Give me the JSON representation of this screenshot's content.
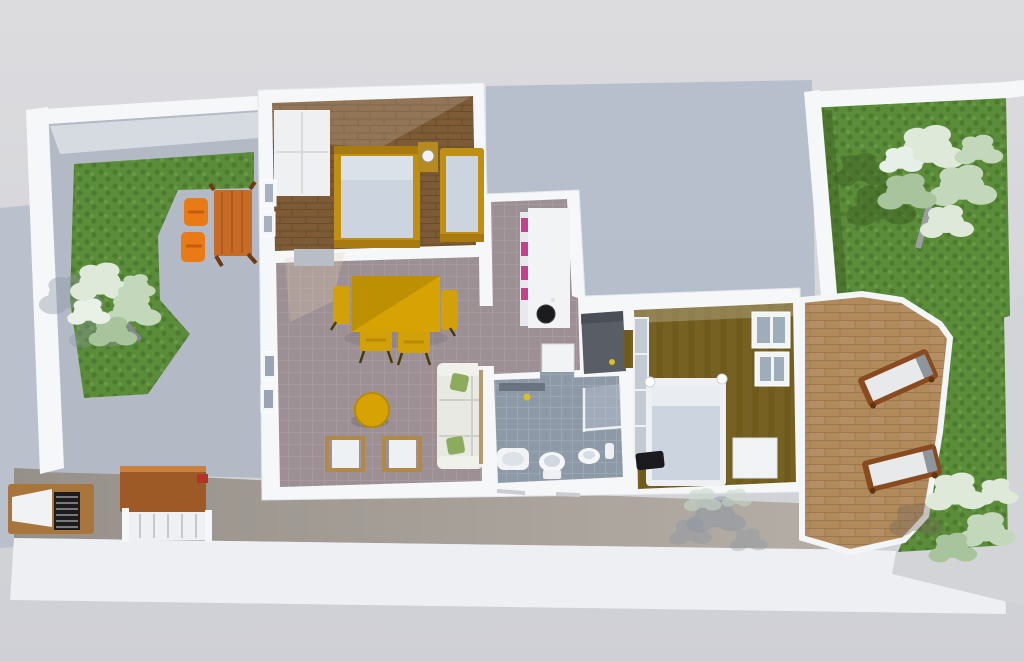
{
  "scene": {
    "type": "3d-floorplan-render",
    "view": "top-down aerial",
    "subject": "two-bedroom apartment with side gardens, patio and terrace"
  },
  "palette": {
    "bg_top": "#dcdcdf",
    "bg_bottom": "#cfd0d5",
    "shadow": "#b5bdca",
    "wall": "#f5f7f9",
    "outer_face": "#edeff2",
    "se_wall": "#d3d4d8",
    "front_wall_dark": "#96908a",
    "front_wall_light": "#b5afa7",
    "concrete": "#b3bac6",
    "concrete_lit": "#dfe3e8",
    "grass": "#5b8c3a",
    "grass_dark": "#4c7a2e",
    "grass_light": "#6a9c46",
    "tile_living": "#9c9095",
    "tile_living_line": "#aca0a5",
    "tile_bath": "#8e99a8",
    "tile_bath_line": "#9fa9b6",
    "wood_floor": "#7c5b36",
    "wood_line": "#6a4c2b",
    "floor_olive": "#776122",
    "olive_band": "#6a561c",
    "floor_dark_room": "#585d66",
    "terrace_stone": "#b18a5c",
    "terrace_joint": "#9a7950",
    "accent_yellow": "#d7a304",
    "accent_yellow_dark": "#b98e02",
    "orange_chair": "#ea7a15",
    "orange_table": "#c76b28",
    "bed_frame_gold": "#bf8f14",
    "mattress_pale": "#ccd5df",
    "sofa_ivory": "#e9e9e4",
    "pillow_green": "#8cab5c",
    "magenta_accent": "#c2418c",
    "sink_black": "#1c1c1f",
    "appliance_white": "#f2f3f5",
    "lounger_wood": "#8a4a1f",
    "lounger_cushion": "#e7e9ea",
    "lounger_headrest": "#8e959c",
    "wood_table_brown": "#9e5a26",
    "shelving_gray": "#c2cad3",
    "dark_item": "#1b1b1f",
    "foliage_light": "#dfe9da",
    "foliage_mid": "#c3d8ba",
    "foliage_deep": "#a8c49c",
    "trunk_gray": "#8b8e93",
    "tree_shadow_gray": "#8d96a4",
    "tree_shadow_green": "#3c5d22"
  },
  "regions": {
    "left_garden": "garden with outdoor dining set and tree",
    "patio": "front patio with barbecue, wooden table and bench",
    "bedroom_1": "bedroom with two single beds and wardrobe",
    "living_dining": "living-dining room",
    "kitchen": "kitchen nook with counter and sink",
    "bathroom": "bathroom with basin, toilet, bidet and shower",
    "storage": "small dark-floored storage room",
    "bedroom_2": "bedroom with double bed and shelving",
    "terrace": "stone terrace with sun loungers",
    "right_garden": "garden with large trees"
  },
  "furniture_counts": {
    "beds": 3,
    "dining_chairs_yellow": 4,
    "garden_chairs_orange": 2,
    "sun_loungers": 2,
    "trees": 4,
    "sofas": 1,
    "deck_chairs": 2
  }
}
